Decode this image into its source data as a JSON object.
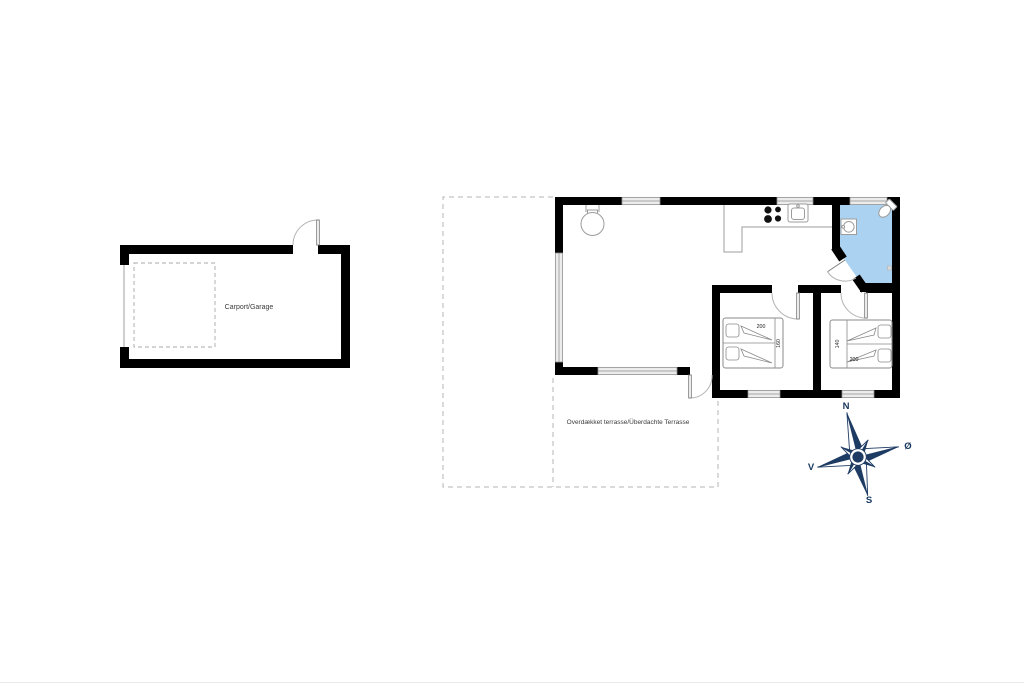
{
  "carport": {
    "label": "Carport/Garage"
  },
  "terrace": {
    "label": "Overdækket terrasse/Überdachte Terrasse"
  },
  "beds": {
    "left": {
      "length": "200",
      "width": "160"
    },
    "right": {
      "length": "200",
      "width": "140"
    }
  },
  "compass": {
    "n": "N",
    "e": "Ø",
    "s": "S",
    "v": "V"
  },
  "colors": {
    "wall": "#000000",
    "bathroom_floor": "#abd3f1",
    "window_fill": "#ececec",
    "compass": "#1e3c63",
    "terrace_dash": "#b5b5b5"
  },
  "icons": {
    "wood_stove": "wood-stove-icon",
    "hob": "hob-icon",
    "kitchen_sink": "kitchen-sink-icon",
    "washbasin": "washbasin-icon",
    "toilet": "toilet-icon",
    "compass_rose": "compass-rose-icon"
  }
}
